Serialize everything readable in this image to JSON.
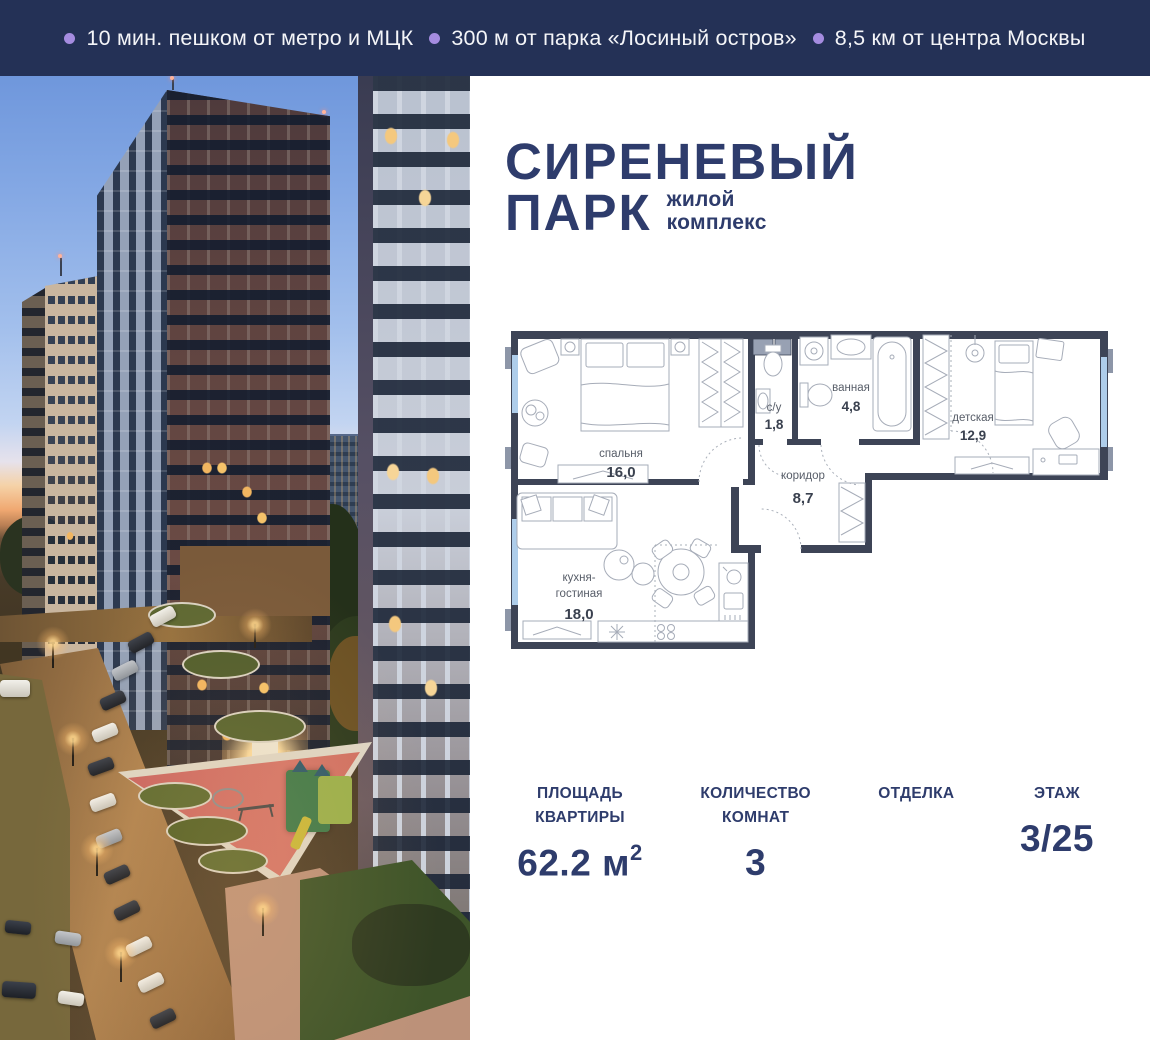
{
  "topbar": {
    "bg_color": "#243156",
    "bullet_color": "#a58ce0",
    "items": [
      {
        "text": "10 мин. пешком от метро и МЦК"
      },
      {
        "text": "300 м от парка «Лосиный остров»"
      },
      {
        "text": "8,5 км от центра Москвы"
      }
    ]
  },
  "logo": {
    "color": "#2e3c6c",
    "title_line1": "СИРЕНЕВЫЙ",
    "title_line2": "ПАРК",
    "subtitle_line1": "жилой",
    "subtitle_line2": "комплекс"
  },
  "photo": {
    "description": "residential towers at dusk with courtyard playground",
    "accent_sky": "#6f97dc",
    "accent_sunset": "#f0a871",
    "playground_color": "#c4635e"
  },
  "floorplan": {
    "wall_color": "#3d4456",
    "window_color": "#aecdea",
    "rooms": [
      {
        "name": "спальня",
        "area": "16,0"
      },
      {
        "name": "с/у",
        "area": "1,8"
      },
      {
        "name": "ванная",
        "area": "4,8"
      },
      {
        "name": "детская",
        "area": "12,9"
      },
      {
        "name": "коридор",
        "area": "8,7"
      },
      {
        "name_line1": "кухня-",
        "name_line2": "гостиная",
        "area": "18,0"
      }
    ]
  },
  "stats": {
    "color": "#2e3c6c",
    "columns": [
      {
        "label": "ПЛОЩАДЬ КВАРТИРЫ",
        "value": "62.2 м",
        "sup": "2"
      },
      {
        "label": "КОЛИЧЕСТВО КОМНАТ",
        "value": "3",
        "sup": ""
      },
      {
        "label": "ОТДЕЛКА",
        "value": "",
        "sup": ""
      },
      {
        "label": "ЭТАЖ",
        "value": "3/25",
        "sup": ""
      }
    ]
  }
}
